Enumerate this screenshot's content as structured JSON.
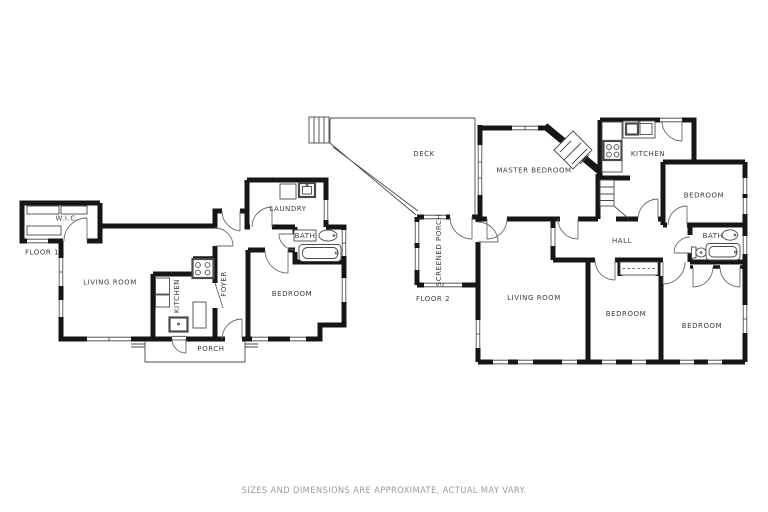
{
  "floor1": {
    "name": "FLOOR 1",
    "rooms": {
      "wic": "W.I.C.",
      "living": "LIVING ROOM",
      "kitchen": "KITCHEN",
      "foyer": "FOYER",
      "bedroom": "BEDROOM",
      "laundry": "LAUNDRY",
      "bath": "BATH",
      "porch": "PORCH"
    }
  },
  "floor2": {
    "name": "FLOOR 2",
    "rooms": {
      "deck": "DECK",
      "master": "MASTER BEDROOM",
      "kitchen": "KITCHEN",
      "bedroom_ne": "BEDROOM",
      "hall": "HALL",
      "bath": "BATH",
      "screened_porch": "SCREENED PORCH",
      "living": "LIVING ROOM",
      "bedroom_s": "BEDROOM",
      "bedroom_se": "BEDROOM"
    }
  },
  "footer": {
    "disclaimer": "SIZES AND DIMENSIONS ARE APPROXIMATE, ACTUAL MAY VARY."
  },
  "colors": {
    "wall": "#161616",
    "thin_line": "#4a4a4a",
    "label_text": "#3d3d3d",
    "footer_text": "#9b9b9b",
    "background": "#ffffff"
  }
}
